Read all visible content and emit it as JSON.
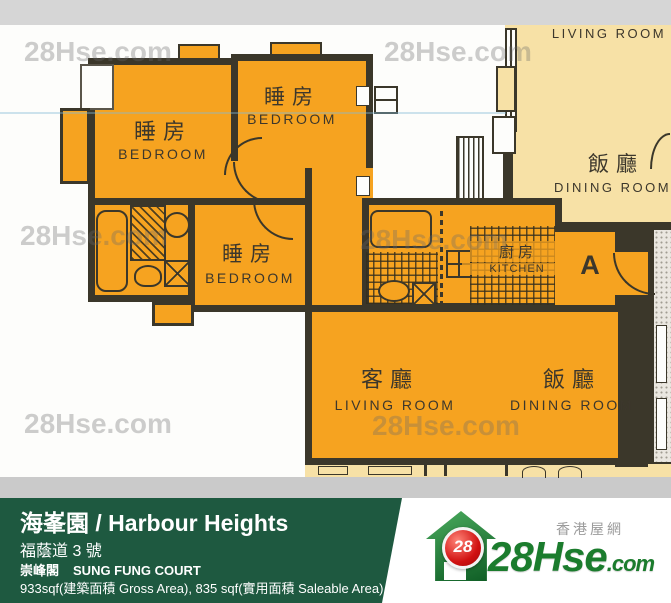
{
  "watermark": {
    "text": "28Hse.com"
  },
  "plan": {
    "unit_label": "A",
    "rooms": {
      "bedroom1": {
        "cn": "睡房",
        "en": "BEDROOM"
      },
      "bedroom2": {
        "cn": "睡房",
        "en": "BEDROOM"
      },
      "bedroom3": {
        "cn": "睡房",
        "en": "BEDROOM"
      },
      "kitchen": {
        "cn": "廚房",
        "en": "KITCHEN"
      },
      "living_room": {
        "cn": "客廳",
        "en": "LIVING ROOM"
      },
      "dining_room": {
        "cn": "飯廳",
        "en": "DINING ROOM"
      },
      "neighbor_living_room": {
        "en": "LIVING ROOM"
      },
      "neighbor_dining_room": {
        "cn": "飯廳",
        "en": "DINING ROOM"
      }
    }
  },
  "footer": {
    "building_title": "海峯園 / Harbour Heights",
    "address": "福蔭道 3 號",
    "block_cn": "崇峰閣",
    "block_en": "SUNG FUNG COURT",
    "area_info": "933sqf(建築面積 Gross Area), 835 sqf(實用面積 Saleable Area)"
  },
  "logo": {
    "site_cn": "香港屋網",
    "badge": "28",
    "brand": "28Hse",
    "tld": ".com"
  },
  "colors": {
    "unit_fill": "#f6a320",
    "neighbor_fill": "#f7e1a6",
    "wall": "#3b372a",
    "footer_green": "#1e5940",
    "logo_green": "#1b7c2d",
    "logo_red": "#d01010",
    "watermark_grey": "#9a9a9a"
  }
}
